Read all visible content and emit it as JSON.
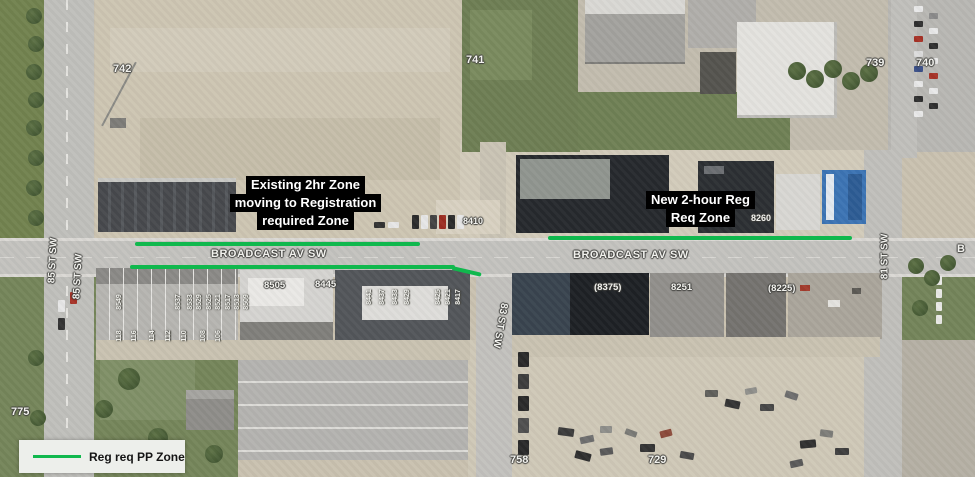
{
  "annotations": {
    "existing_zone": {
      "line1": "Existing 2hr Zone",
      "line2": "moving to Registration",
      "line3": "required Zone"
    },
    "new_zone": {
      "line1": "New 2-hour Reg",
      "line2": "Req Zone"
    },
    "colors": {
      "zone_line": "#10b84d",
      "callout_bg": "#000000",
      "callout_fg": "#ffffff"
    }
  },
  "legend": {
    "label": "Reg req PP Zone"
  },
  "streets": {
    "broadcast_west": "BROADCAST AV SW",
    "broadcast_east": "BROADCAST AV SW",
    "broadcast_east_edge": "B",
    "st85_left": "85 ST SW",
    "st85_right": "85 ST SW",
    "st83": "83 ST SW",
    "st81": "81 ST SW"
  },
  "parcel_numbers": {
    "p742": "742",
    "p741": "741",
    "p739": "739",
    "p740": "740",
    "p8410": "8410",
    "p8260": "8260",
    "p8505": "8505",
    "p8445": "8445",
    "p8375": "(8375)",
    "p8251": "8251",
    "p8225": "(8225)",
    "p775": "775",
    "p758": "758",
    "p729": "729"
  },
  "unit_numbers": {
    "row_west_top": [
      "8549",
      "8537",
      "8533",
      "8529",
      "8525",
      "8521",
      "8517",
      "8513",
      "8509"
    ],
    "row_west_bottom": [
      "118",
      "116",
      "114",
      "112",
      "110",
      "108",
      "106"
    ],
    "row_mid": [
      "8441",
      "8437",
      "8433",
      "8429",
      "8425",
      "8421",
      "8417"
    ]
  }
}
